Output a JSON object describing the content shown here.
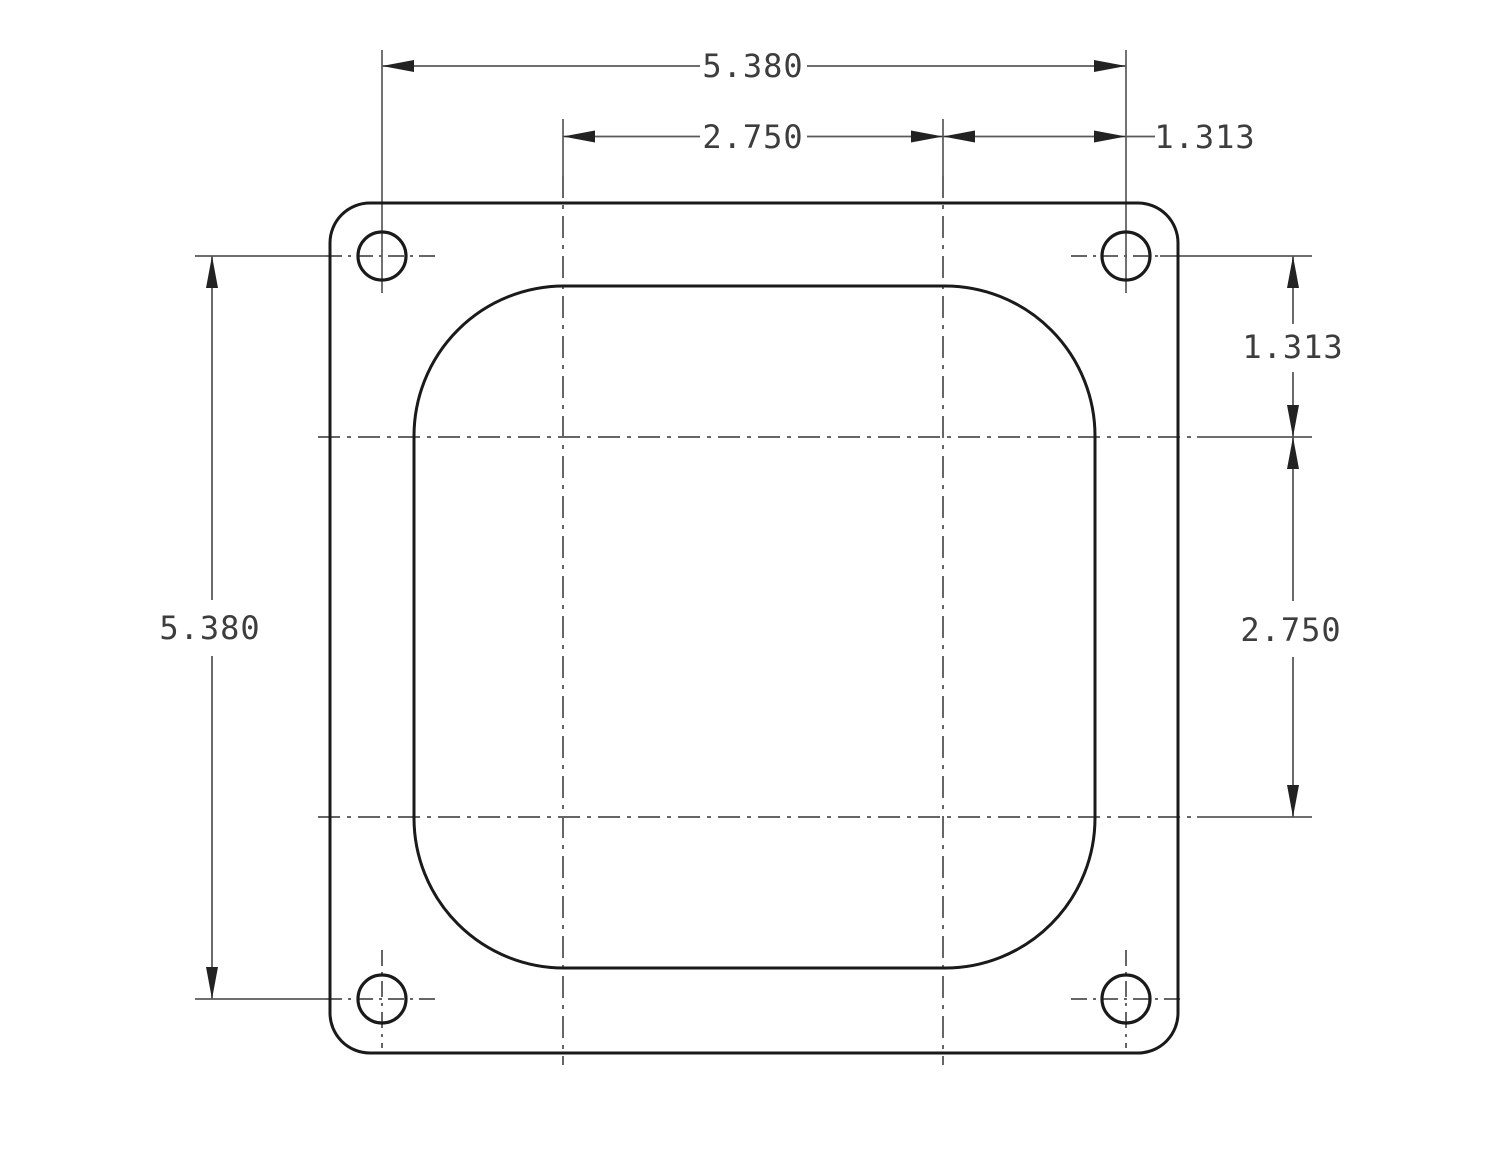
{
  "drawing": {
    "dimensions": {
      "overall_width": "5.380",
      "bore_spacing_horizontal": "2.750",
      "bolt_offset_horizontal": "1.313",
      "overall_height": "5.380",
      "bolt_offset_vertical": "1.313",
      "bore_spacing_vertical": "2.750"
    },
    "colors": {
      "background": "#ffffff",
      "outline": "#1a1a1a",
      "dimension_lines": "#5a5a5a",
      "centerlines": "#666666",
      "text": "#3d3d3d"
    }
  }
}
